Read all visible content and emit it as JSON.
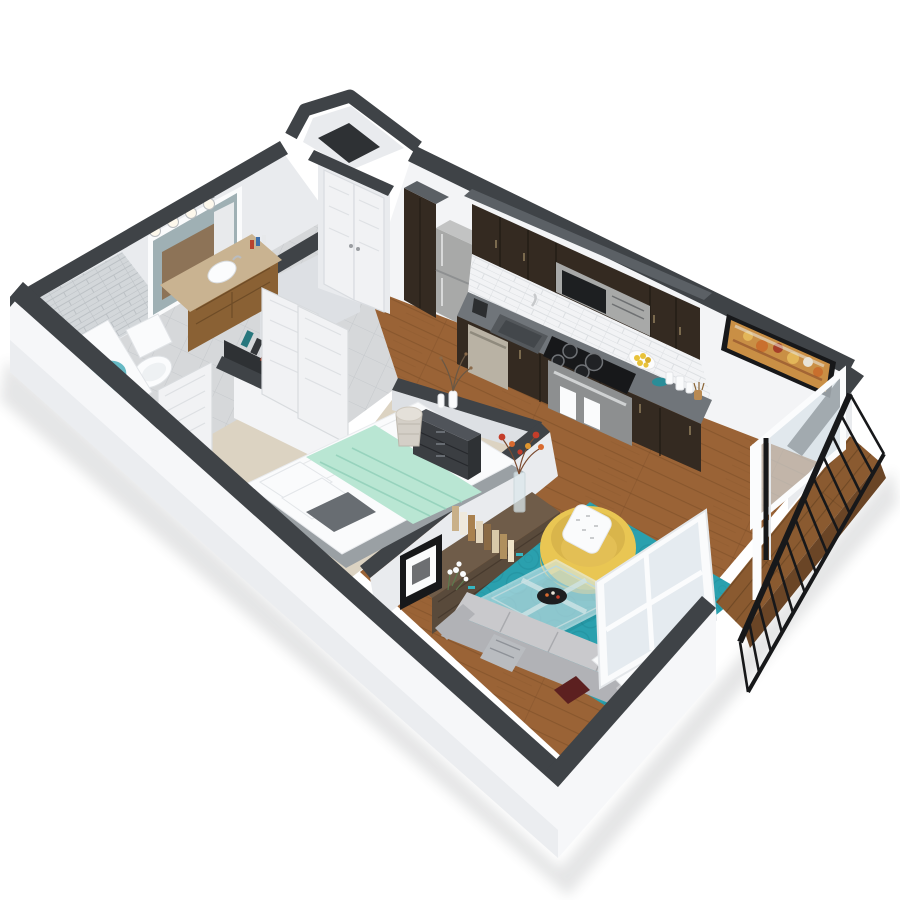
{
  "meta": {
    "title": "3D isometric cutaway floor plan rendering of a one-bedroom apartment",
    "view": "isometric cutaway, white walls with dark charcoal wall caps, no visible text"
  },
  "colors": {
    "cap": "#3f4347",
    "capDark": "#2e3134",
    "wallLit": "#f3f4f6",
    "wallMid": "#e9ebee",
    "wallShade": "#dde0e4",
    "extFace": "#f6f7f9",
    "tileFloor": "#d6d8da",
    "tileWall": "#d3d7da",
    "grout": "#c2c5c9",
    "wood": "#9a6336",
    "woodDark": "#7a4c26",
    "carpet": "#dcd3c2",
    "rug": "#2aa0ae",
    "rugDark": "#1f8c99",
    "cabinet": "#342a21",
    "cabinetTop": "#5b6065",
    "cabinetSide": "#241d16",
    "counter": "#70757a",
    "steel": "#a8a9a8",
    "steelDark": "#8d8f90",
    "white": "#fafbfc",
    "mint": "#b9e6d3",
    "mintDark": "#97d3bd",
    "sofa": "#c9c9cc",
    "sofaDark": "#b1b2b6",
    "chair": "#e9c653",
    "chairDark": "#b9b261",
    "console": "#6f5c49",
    "consoleDark": "#594a3b",
    "door": "#f1f2f4",
    "doorShade": "#d9dce0",
    "railing": "#17181a",
    "deck": "#8a5a30",
    "water": "#66b9c4",
    "frameBlack": "#17181a",
    "vanityWood": "#8a6134",
    "vanityTop": "#c9b391",
    "accentRed": "#5c2020",
    "lemon": "#e8c23a",
    "artOrange": "#c96f2e"
  },
  "scene": {
    "rooms": [
      {
        "name": "bathroom",
        "items": [
          "vanity with wood cabinet and tan counter",
          "round white sink",
          "mirror with 4-bulb light bar",
          "toilet",
          "bathtub with water",
          "gray subway-tile shower wall",
          "toiletry bottles"
        ]
      },
      {
        "name": "hall-closet",
        "items": [
          "shoe shelving with colorful shoes",
          "white paneled swing doors",
          "gray tile floor"
        ]
      },
      {
        "name": "entry",
        "items": [
          "white double closet doors",
          "entry nook with dark floor"
        ]
      },
      {
        "name": "bedroom",
        "items": [
          "bed with white bedding and mint throw blanket",
          "white pillows and dark gray accent pillow",
          "dark gray 3-drawer dresser",
          "white vases with branches",
          "woven basket",
          "beige carpet"
        ]
      },
      {
        "name": "kitchen",
        "items": [
          "stainless top-freezer refrigerator",
          "tall espresso pantry cabinet",
          "espresso upper and lower cabinets",
          "stainless over-range microwave",
          "black electric cooktop with oven and two white towels",
          "gray granite countertop",
          "undermount sink with faucet",
          "dishwasher",
          "plate of lemons",
          "white canisters",
          "utensil crock",
          "white subway-tile backsplash"
        ]
      },
      {
        "name": "living-room",
        "items": [
          "teal circle-pattern area rug",
          "yellow barrel chair with white patterned pillow",
          "glass coffee table with black decor bowl",
          "gray sectional sofa with white and dark-red pillows and throw",
          "rustic media console with books, black picture frame, white flowers and tall vase of orange flowers",
          "abstract orange wall art in black frame",
          "leaning white-framed window panel"
        ]
      },
      {
        "name": "balcony",
        "items": [
          "wood plank deck",
          "black metal railing",
          "white sliding glass door"
        ]
      }
    ]
  }
}
